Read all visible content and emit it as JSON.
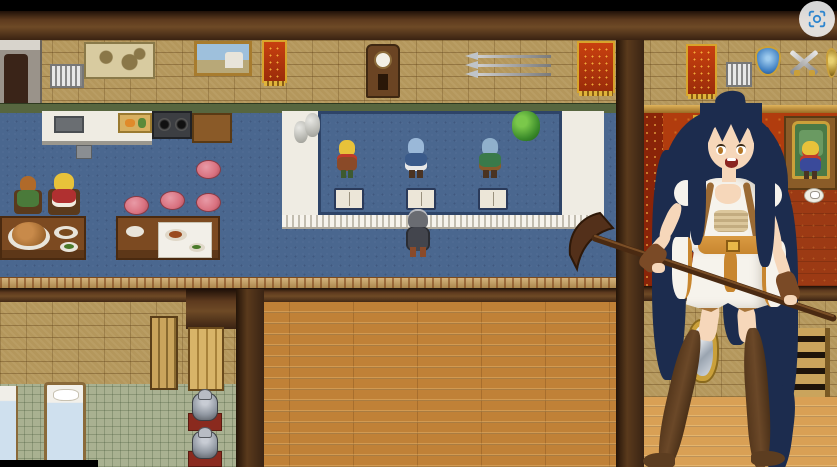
{
  "palette": {
    "overlay-black": "#000000",
    "beam-dark": "#33200f",
    "wall-tan": "#b4975c",
    "green-band": "#57663f",
    "trim-gold": "#c79a52",
    "carpet-blue": "#4a678f",
    "counter-white": "#efece3",
    "wood-floor": "#c08137",
    "wood-light": "#d9a055",
    "bedroom-floor": "#a9b191",
    "red-wall": "#b13c0e",
    "red-carpet": "#9c3a14",
    "stool-pink": "#d9717f",
    "table-brown": "#7c4a21",
    "armor-grey": "#9097a1",
    "hair-navy": "#1c2c4e",
    "skin": "#f6d7ba",
    "dress-white": "#f6f3ec",
    "sash-orange": "#c8862f",
    "boot-brown": "#6b4828",
    "capture-blue": "#2f86cf"
  },
  "hud": {
    "screenshot_button": {
      "icon": "screen-capture-icon",
      "shape": "white-circle"
    }
  },
  "scene": {
    "setting": "tavern-inn-interior",
    "wall_decor": [
      "stone-hearth",
      "barred-window",
      "world-map",
      "landscape-painting",
      "red-banner",
      "grandfather-clock",
      "spear-rack",
      "red-banner-large",
      "red-banner-right",
      "barred-window",
      "blue-shield",
      "crossed-swords",
      "gold-shield",
      "wall-panel",
      "wall-mirror",
      "wall-ladder"
    ],
    "furniture": [
      "kitchen-sink-counter",
      "cutting-board",
      "stove",
      "side-table",
      "dining-table-with-roast",
      "dining-table-with-cloth",
      "pink-stools",
      "reception-counter",
      "guest-books",
      "water-jugs",
      "potted-bush",
      "beds",
      "armor-stands",
      "throne",
      "teacup"
    ],
    "npcs": [
      {
        "id": "diner-redhead",
        "desc": "seated villager in green at dining table"
      },
      {
        "id": "diner-blonde",
        "desc": "seated girl in red dress at dining table"
      },
      {
        "id": "clerk-blonde",
        "desc": "blonde counter clerk in red scarf"
      },
      {
        "id": "clerk-bluehair",
        "desc": "blue-haired counter maid in blue dress"
      },
      {
        "id": "clerk-greencoat",
        "desc": "blue-haired counter clerk in green coat"
      },
      {
        "id": "throne-attendant",
        "desc": "blonde attendant in red hat beside throne"
      }
    ],
    "player": {
      "id": "player-hero",
      "desc": "grey-cloaked hero standing at the reception counter"
    },
    "portrait": {
      "id": "heroine-portrait",
      "desc": "long navy-haired girl in a white dress and thigh-high boots holding a pickaxe"
    }
  }
}
